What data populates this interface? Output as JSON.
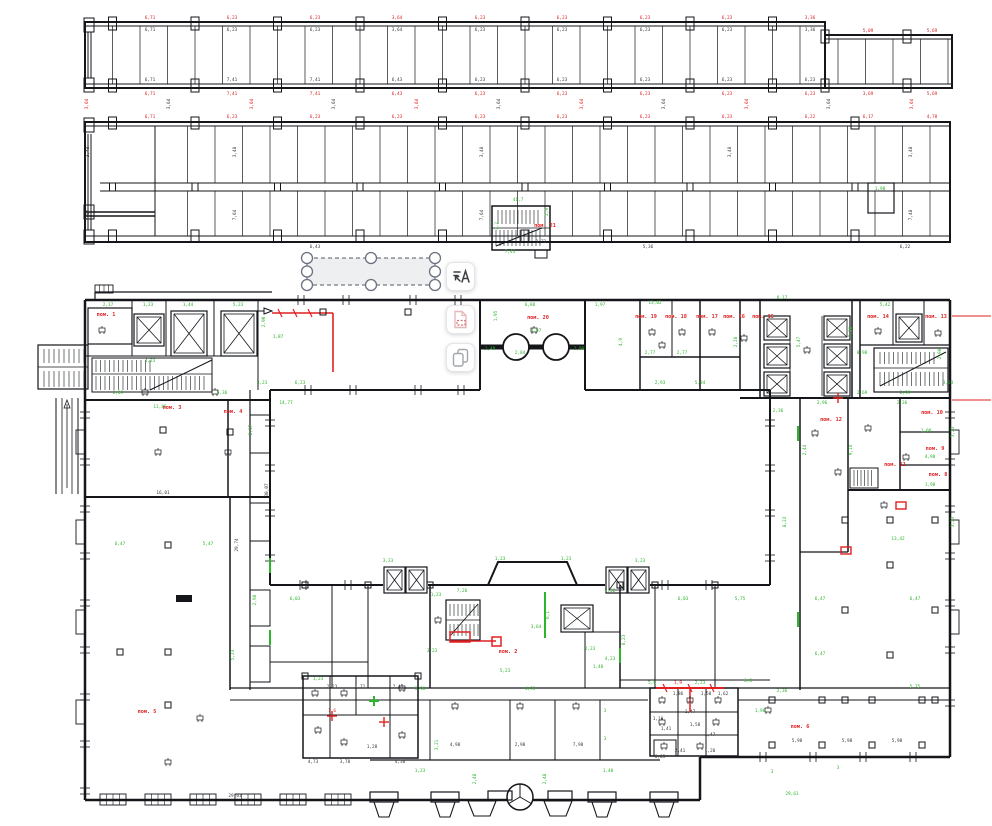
{
  "colors": {
    "wall": "#14161a",
    "dim_green": "#2bb52b",
    "dim_red": "#e02020",
    "dim_black": "#3a3a3a",
    "selection_fill": "#ebedf0",
    "selection_stroke": "#555a63",
    "button_bg": "#ffffff"
  },
  "toolbar": {
    "buttons": [
      {
        "name": "recognize-text-button",
        "icon": "text-scan-icon"
      },
      {
        "name": "highlight-region-button",
        "icon": "page-red-dashed-icon"
      },
      {
        "name": "duplicate-layer-button",
        "icon": "copy-icon"
      }
    ]
  },
  "selection": {
    "handle_count": 8
  },
  "room_labels": [
    {
      "t": "пом. 1",
      "x": 106,
      "y": 316
    },
    {
      "t": "пом. 2",
      "x": 508,
      "y": 653
    },
    {
      "t": "пом. 3",
      "x": 172,
      "y": 409
    },
    {
      "t": "пом. 4",
      "x": 233,
      "y": 413
    },
    {
      "t": "пом. 5",
      "x": 147,
      "y": 713
    },
    {
      "t": "пом. 6",
      "x": 800,
      "y": 728
    },
    {
      "t": "пом. 8",
      "x": 938,
      "y": 476
    },
    {
      "t": "пом. 9",
      "x": 935,
      "y": 450
    },
    {
      "t": "пом. 10",
      "x": 932,
      "y": 414
    },
    {
      "t": "пом. 11",
      "x": 895,
      "y": 466
    },
    {
      "t": "пом. 12",
      "x": 831,
      "y": 421
    },
    {
      "t": "пом. 13",
      "x": 936,
      "y": 318
    },
    {
      "t": "пом. 14",
      "x": 878,
      "y": 318
    },
    {
      "t": "пом. 15",
      "x": 763,
      "y": 318
    },
    {
      "t": "пом. 16",
      "x": 734,
      "y": 318
    },
    {
      "t": "пом. 17",
      "x": 707,
      "y": 318
    },
    {
      "t": "пом. 18",
      "x": 676,
      "y": 318
    },
    {
      "t": "пом. 19",
      "x": 646,
      "y": 318
    },
    {
      "t": "пом. 20",
      "x": 538,
      "y": 319
    },
    {
      "t": "пом. 21",
      "x": 545,
      "y": 227
    }
  ],
  "dim_labels": [
    [
      150,
      19,
      "6,71",
      "r"
    ],
    [
      232,
      19,
      "6,23",
      "r"
    ],
    [
      315,
      19,
      "6,23",
      "r"
    ],
    [
      397,
      19,
      "3,64",
      "r"
    ],
    [
      480,
      19,
      "6,23",
      "r"
    ],
    [
      562,
      19,
      "6,23",
      "r"
    ],
    [
      645,
      19,
      "6,23",
      "r"
    ],
    [
      727,
      19,
      "6,23",
      "r"
    ],
    [
      810,
      19,
      "3,36",
      "r"
    ],
    [
      868,
      32,
      "5,09",
      "r"
    ],
    [
      932,
      32,
      "5,69",
      "r"
    ],
    [
      150,
      31,
      "6,71",
      "k"
    ],
    [
      232,
      31,
      "6,23",
      "k"
    ],
    [
      315,
      31,
      "6,23",
      "k"
    ],
    [
      397,
      31,
      "3,64",
      "k"
    ],
    [
      480,
      31,
      "6,23",
      "k"
    ],
    [
      562,
      31,
      "6,23",
      "k"
    ],
    [
      645,
      31,
      "6,23",
      "k"
    ],
    [
      727,
      31,
      "6,23",
      "k"
    ],
    [
      810,
      31,
      "3,36",
      "k"
    ],
    [
      150,
      81,
      "6,71",
      "k"
    ],
    [
      232,
      81,
      "7,41",
      "k"
    ],
    [
      315,
      81,
      "7,41",
      "k"
    ],
    [
      397,
      81,
      "6,43",
      "k"
    ],
    [
      480,
      81,
      "6,23",
      "k"
    ],
    [
      562,
      81,
      "6,23",
      "k"
    ],
    [
      645,
      81,
      "6,23",
      "k"
    ],
    [
      727,
      81,
      "6,23",
      "k"
    ],
    [
      810,
      81,
      "6,23",
      "k"
    ],
    [
      150,
      95,
      "6,71",
      "r"
    ],
    [
      232,
      95,
      "7,41",
      "r"
    ],
    [
      315,
      95,
      "7,41",
      "r"
    ],
    [
      397,
      95,
      "6,43",
      "r"
    ],
    [
      480,
      95,
      "6,23",
      "r"
    ],
    [
      562,
      95,
      "6,23",
      "r"
    ],
    [
      645,
      95,
      "6,23",
      "r"
    ],
    [
      727,
      95,
      "6,23",
      "r"
    ],
    [
      810,
      95,
      "6,23",
      "r"
    ],
    [
      868,
      95,
      "3,69",
      "r"
    ],
    [
      932,
      95,
      "5,69",
      "r"
    ],
    [
      88,
      104,
      "3,64",
      "r",
      1
    ],
    [
      170,
      104,
      "3,64",
      "k",
      1
    ],
    [
      253,
      104,
      "3,64",
      "r",
      1
    ],
    [
      335,
      104,
      "3,64",
      "k",
      1
    ],
    [
      418,
      104,
      "3,64",
      "r",
      1
    ],
    [
      500,
      104,
      "3,64",
      "k",
      1
    ],
    [
      583,
      104,
      "3,64",
      "r",
      1
    ],
    [
      665,
      104,
      "3,64",
      "k",
      1
    ],
    [
      748,
      104,
      "3,64",
      "r",
      1
    ],
    [
      830,
      104,
      "3,64",
      "k",
      1
    ],
    [
      913,
      104,
      "3,64",
      "r",
      1
    ],
    [
      150,
      118,
      "6,71",
      "r"
    ],
    [
      232,
      118,
      "6,23",
      "r"
    ],
    [
      315,
      118,
      "6,23",
      "r"
    ],
    [
      397,
      118,
      "6,23",
      "r"
    ],
    [
      480,
      118,
      "6,23",
      "r"
    ],
    [
      562,
      118,
      "6,23",
      "r"
    ],
    [
      645,
      118,
      "6,23",
      "r"
    ],
    [
      727,
      118,
      "6,23",
      "r"
    ],
    [
      810,
      118,
      "6,22",
      "r"
    ],
    [
      868,
      118,
      "6,17",
      "r"
    ],
    [
      932,
      118,
      "4,78",
      "r"
    ],
    [
      89,
      152,
      "3,48",
      "k",
      1
    ],
    [
      89,
      215,
      "7,64",
      "k",
      1
    ],
    [
      236,
      152,
      "3,48",
      "k",
      1
    ],
    [
      236,
      215,
      "7,64",
      "k",
      1
    ],
    [
      483,
      152,
      "3,48",
      "k",
      1
    ],
    [
      483,
      215,
      "7,64",
      "k",
      1
    ],
    [
      731,
      152,
      "3,48",
      "k",
      1
    ],
    [
      912,
      152,
      "3,48",
      "k",
      1
    ],
    [
      912,
      215,
      "7,48",
      "k",
      1
    ],
    [
      315,
      248,
      "6,43",
      "k"
    ],
    [
      648,
      248,
      "5,36",
      "k"
    ],
    [
      905,
      248,
      "6,22",
      "k"
    ],
    [
      518,
      201,
      "41,7",
      "g"
    ],
    [
      498,
      226,
      "3,2",
      "g",
      1
    ],
    [
      548,
      212,
      "2,9",
      "g",
      1
    ],
    [
      510,
      253,
      "7,43",
      "g"
    ],
    [
      880,
      190,
      "1,98",
      "g"
    ],
    [
      541,
      243,
      "1,73",
      "k"
    ],
    [
      108,
      306,
      "2,17",
      "g"
    ],
    [
      148,
      306,
      "1,23",
      "g"
    ],
    [
      188,
      306,
      "1,44",
      "g"
    ],
    [
      238,
      306,
      "5,23",
      "g"
    ],
    [
      265,
      322,
      "2,90",
      "g",
      1
    ],
    [
      278,
      338,
      "1,87",
      "g"
    ],
    [
      262,
      384,
      "3,23",
      "g"
    ],
    [
      300,
      384,
      "6,23",
      "g"
    ],
    [
      118,
      394,
      "2,09",
      "g"
    ],
    [
      222,
      394,
      "5,36",
      "g"
    ],
    [
      150,
      362,
      "4,23",
      "g"
    ],
    [
      497,
      316,
      "1,95",
      "g",
      1
    ],
    [
      530,
      306,
      "6,88",
      "g"
    ],
    [
      536,
      332,
      "4,97",
      "g"
    ],
    [
      520,
      354,
      "2,84",
      "g"
    ],
    [
      490,
      350,
      "1,48",
      "g"
    ],
    [
      579,
      350,
      "1,98",
      "g"
    ],
    [
      600,
      306,
      "1,97",
      "g"
    ],
    [
      655,
      304,
      "13,02",
      "g"
    ],
    [
      622,
      342,
      "4,9",
      "g",
      1
    ],
    [
      650,
      354,
      "2,77",
      "g"
    ],
    [
      682,
      354,
      "2,77",
      "g"
    ],
    [
      737,
      342,
      "2,28",
      "g",
      1
    ],
    [
      700,
      384,
      "5,34",
      "g"
    ],
    [
      660,
      384,
      "2,93",
      "g"
    ],
    [
      782,
      299,
      "8,17",
      "g"
    ],
    [
      800,
      342,
      "5,47",
      "g",
      1
    ],
    [
      852,
      332,
      "7,38",
      "g",
      1
    ],
    [
      885,
      306,
      "5,42",
      "g"
    ],
    [
      862,
      354,
      "0,98",
      "g"
    ],
    [
      941,
      354,
      "2,98",
      "g",
      1
    ],
    [
      948,
      384,
      "3,23",
      "g"
    ],
    [
      905,
      394,
      "2,99",
      "g"
    ],
    [
      862,
      394,
      "2,69",
      "g"
    ],
    [
      778,
      412,
      "2,36",
      "g"
    ],
    [
      822,
      404,
      "2,96",
      "g"
    ],
    [
      902,
      404,
      "2,36",
      "g"
    ],
    [
      806,
      450,
      "2,44",
      "g",
      1
    ],
    [
      852,
      450,
      "9,14",
      "g",
      1
    ],
    [
      926,
      432,
      "1,08",
      "g"
    ],
    [
      930,
      458,
      "4,98",
      "g"
    ],
    [
      930,
      486,
      "1,98",
      "g"
    ],
    [
      786,
      522,
      "8,23",
      "g",
      1
    ],
    [
      898,
      540,
      "13,42",
      "g"
    ],
    [
      820,
      600,
      "6,47",
      "g"
    ],
    [
      915,
      600,
      "6,47",
      "g"
    ],
    [
      820,
      655,
      "6,47",
      "g"
    ],
    [
      915,
      688,
      "5,75",
      "g"
    ],
    [
      782,
      692,
      "2,36",
      "g"
    ],
    [
      160,
      408,
      "11,85",
      "g"
    ],
    [
      286,
      404,
      "14,77",
      "g"
    ],
    [
      252,
      430,
      "2,17",
      "g",
      1
    ],
    [
      208,
      545,
      "5,47",
      "g"
    ],
    [
      120,
      545,
      "6,47",
      "g"
    ],
    [
      256,
      600,
      "2,98",
      "g",
      1
    ],
    [
      234,
      655,
      "5,23",
      "g",
      1
    ],
    [
      163,
      494,
      "16,01",
      "k"
    ],
    [
      238,
      545,
      "29,74",
      "k",
      1
    ],
    [
      268,
      490,
      "30,07",
      "k",
      1
    ],
    [
      295,
      600,
      "6,03",
      "g"
    ],
    [
      683,
      600,
      "6,03",
      "g"
    ],
    [
      740,
      600,
      "5,75",
      "g"
    ],
    [
      436,
      596,
      "1,23",
      "g"
    ],
    [
      462,
      592,
      "7,26",
      "g"
    ],
    [
      610,
      592,
      "7,32",
      "g"
    ],
    [
      432,
      652,
      "3,23",
      "g"
    ],
    [
      505,
      672,
      "5,23",
      "g"
    ],
    [
      610,
      660,
      "4,23",
      "g"
    ],
    [
      625,
      640,
      "6,23",
      "g",
      1
    ],
    [
      536,
      628,
      "3,64",
      "g"
    ],
    [
      590,
      650,
      "2,23",
      "g"
    ],
    [
      598,
      668,
      "1,48",
      "g"
    ],
    [
      318,
      680,
      "1,23",
      "g"
    ],
    [
      420,
      690,
      "5,98",
      "g"
    ],
    [
      530,
      690,
      "4,98",
      "g"
    ],
    [
      438,
      745,
      "3,21",
      "g",
      1
    ],
    [
      605,
      712,
      "3",
      "g"
    ],
    [
      605,
      740,
      "3",
      "g"
    ],
    [
      772,
      773,
      "3",
      "g"
    ],
    [
      838,
      769,
      "3",
      "g"
    ],
    [
      760,
      712,
      "1,98",
      "g"
    ],
    [
      500,
      560,
      "1,23",
      "g"
    ],
    [
      566,
      560,
      "1,23",
      "g"
    ],
    [
      388,
      562,
      "3,23",
      "g"
    ],
    [
      640,
      562,
      "3,23",
      "g"
    ],
    [
      652,
      684,
      "5,0",
      "g"
    ],
    [
      700,
      684,
      "2,23",
      "g"
    ],
    [
      748,
      682,
      "6,0",
      "g"
    ],
    [
      678,
      684,
      "1,9",
      "r"
    ],
    [
      332,
      712,
      "1,6",
      "r"
    ],
    [
      313,
      763,
      "4,73",
      "k"
    ],
    [
      345,
      763,
      "3,78",
      "k"
    ],
    [
      372,
      748,
      "1,28",
      "k"
    ],
    [
      400,
      763,
      "4,38",
      "k"
    ],
    [
      455,
      746,
      "4,98",
      "k"
    ],
    [
      520,
      746,
      "2,98",
      "k"
    ],
    [
      578,
      746,
      "7,98",
      "k"
    ],
    [
      797,
      742,
      "5,98",
      "k"
    ],
    [
      847,
      742,
      "5,98",
      "k"
    ],
    [
      897,
      742,
      "5,98",
      "k"
    ],
    [
      660,
      758,
      "6,03",
      "k"
    ],
    [
      690,
      713,
      "1,47",
      "k"
    ],
    [
      666,
      730,
      "1,41",
      "k"
    ],
    [
      710,
      736,
      "1,47",
      "k"
    ],
    [
      678,
      695,
      "1,86",
      "k"
    ],
    [
      706,
      695,
      "1,50",
      "k"
    ],
    [
      723,
      695,
      "1,62",
      "k"
    ],
    [
      658,
      720,
      "1,10",
      "k"
    ],
    [
      695,
      726,
      "1,58",
      "k"
    ],
    [
      680,
      752,
      "2,41",
      "k"
    ],
    [
      710,
      752,
      "1,20",
      "k"
    ],
    [
      332,
      688,
      "2,23",
      "k"
    ],
    [
      360,
      688,
      "1,71",
      "k"
    ],
    [
      398,
      688,
      "2,41",
      "k"
    ],
    [
      235,
      797,
      "29,61",
      "k"
    ],
    [
      792,
      795,
      "29,61",
      "g"
    ],
    [
      476,
      779,
      "2,48",
      "g",
      1
    ],
    [
      546,
      779,
      "2,48",
      "g",
      1
    ],
    [
      420,
      772,
      "1,23",
      "g"
    ],
    [
      608,
      772,
      "1,48",
      "g"
    ],
    [
      549,
      615,
      "6,1",
      "g",
      1
    ],
    [
      954,
      432,
      "3,23",
      "g",
      1
    ],
    [
      954,
      522,
      "3,23",
      "g",
      1
    ]
  ]
}
